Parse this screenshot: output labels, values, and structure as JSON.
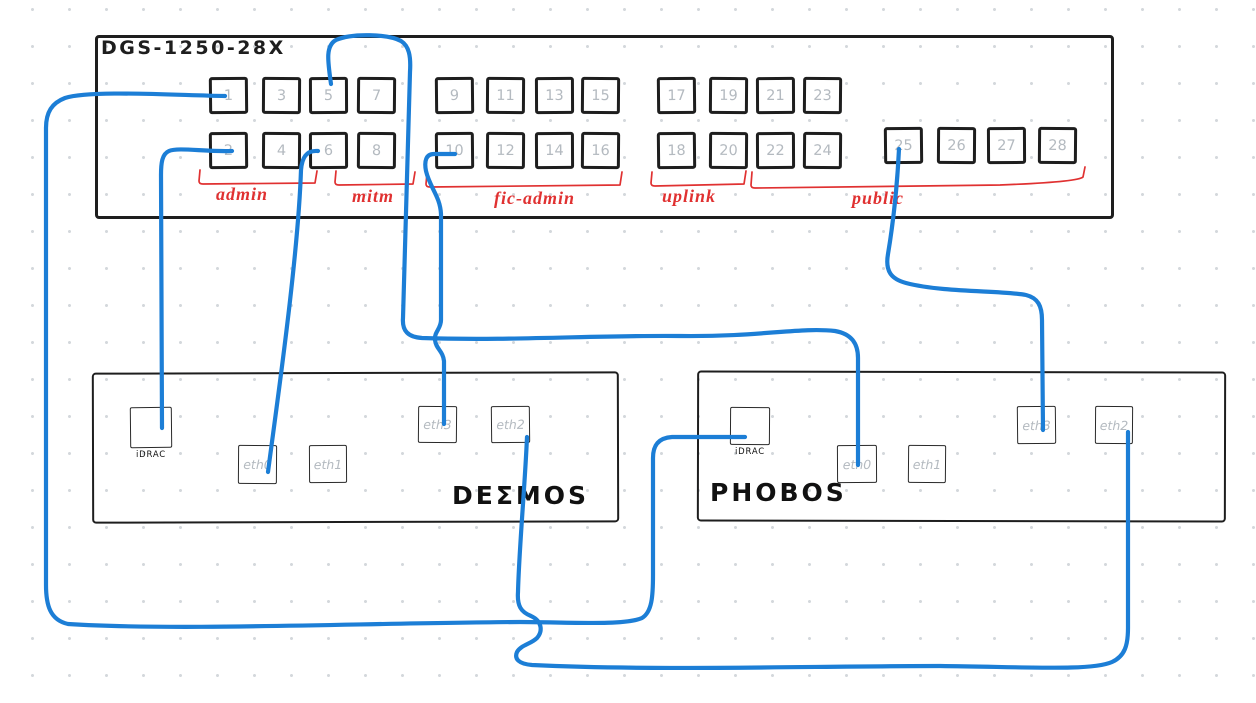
{
  "switch": {
    "title": "DGS-1250-28X",
    "top_row_ports": [
      "1",
      "3",
      "5",
      "7",
      "9",
      "11",
      "13",
      "15",
      "17",
      "19",
      "21",
      "23"
    ],
    "bottom_row_ports": [
      "2",
      "4",
      "6",
      "8",
      "10",
      "12",
      "14",
      "16",
      "18",
      "20",
      "22",
      "24"
    ],
    "sfp_row_ports": [
      "25",
      "26",
      "27",
      "28"
    ],
    "port_groups": [
      {
        "label": "admin",
        "ports": "1–4"
      },
      {
        "label": "mitm",
        "ports": "5–8"
      },
      {
        "label": "fic-admin",
        "ports": "9–16"
      },
      {
        "label": "uplink",
        "ports": "17–20"
      },
      {
        "label": "public",
        "ports": "21–28"
      }
    ]
  },
  "servers": [
    {
      "name": "DEΣMOS",
      "ports": [
        "iDRAC",
        "eth0",
        "eth1",
        "eth3",
        "eth2"
      ]
    },
    {
      "name": "PHOBOS",
      "ports": [
        "iDRAC",
        "eth0",
        "eth1",
        "eth3",
        "eth2"
      ]
    }
  ],
  "connections": [
    {
      "from": "switch port 1",
      "to": "PHOBOS iDRAC"
    },
    {
      "from": "switch port 2",
      "to": "DEΣMOS iDRAC"
    },
    {
      "from": "switch port 5",
      "to": "PHOBOS eth0"
    },
    {
      "from": "switch port 6",
      "to": "DEΣMOS eth0"
    },
    {
      "from": "switch port 10",
      "to": "DEΣMOS eth3"
    },
    {
      "from": "switch port 25",
      "to": "PHOBOS eth3"
    },
    {
      "from": "DEΣMOS eth2",
      "to": "PHOBOS eth2"
    }
  ],
  "colors": {
    "stroke": "#1e1e1e",
    "cable": "#1c7ed6",
    "annotation": "#e03131",
    "port_number": "#b4bac0"
  }
}
